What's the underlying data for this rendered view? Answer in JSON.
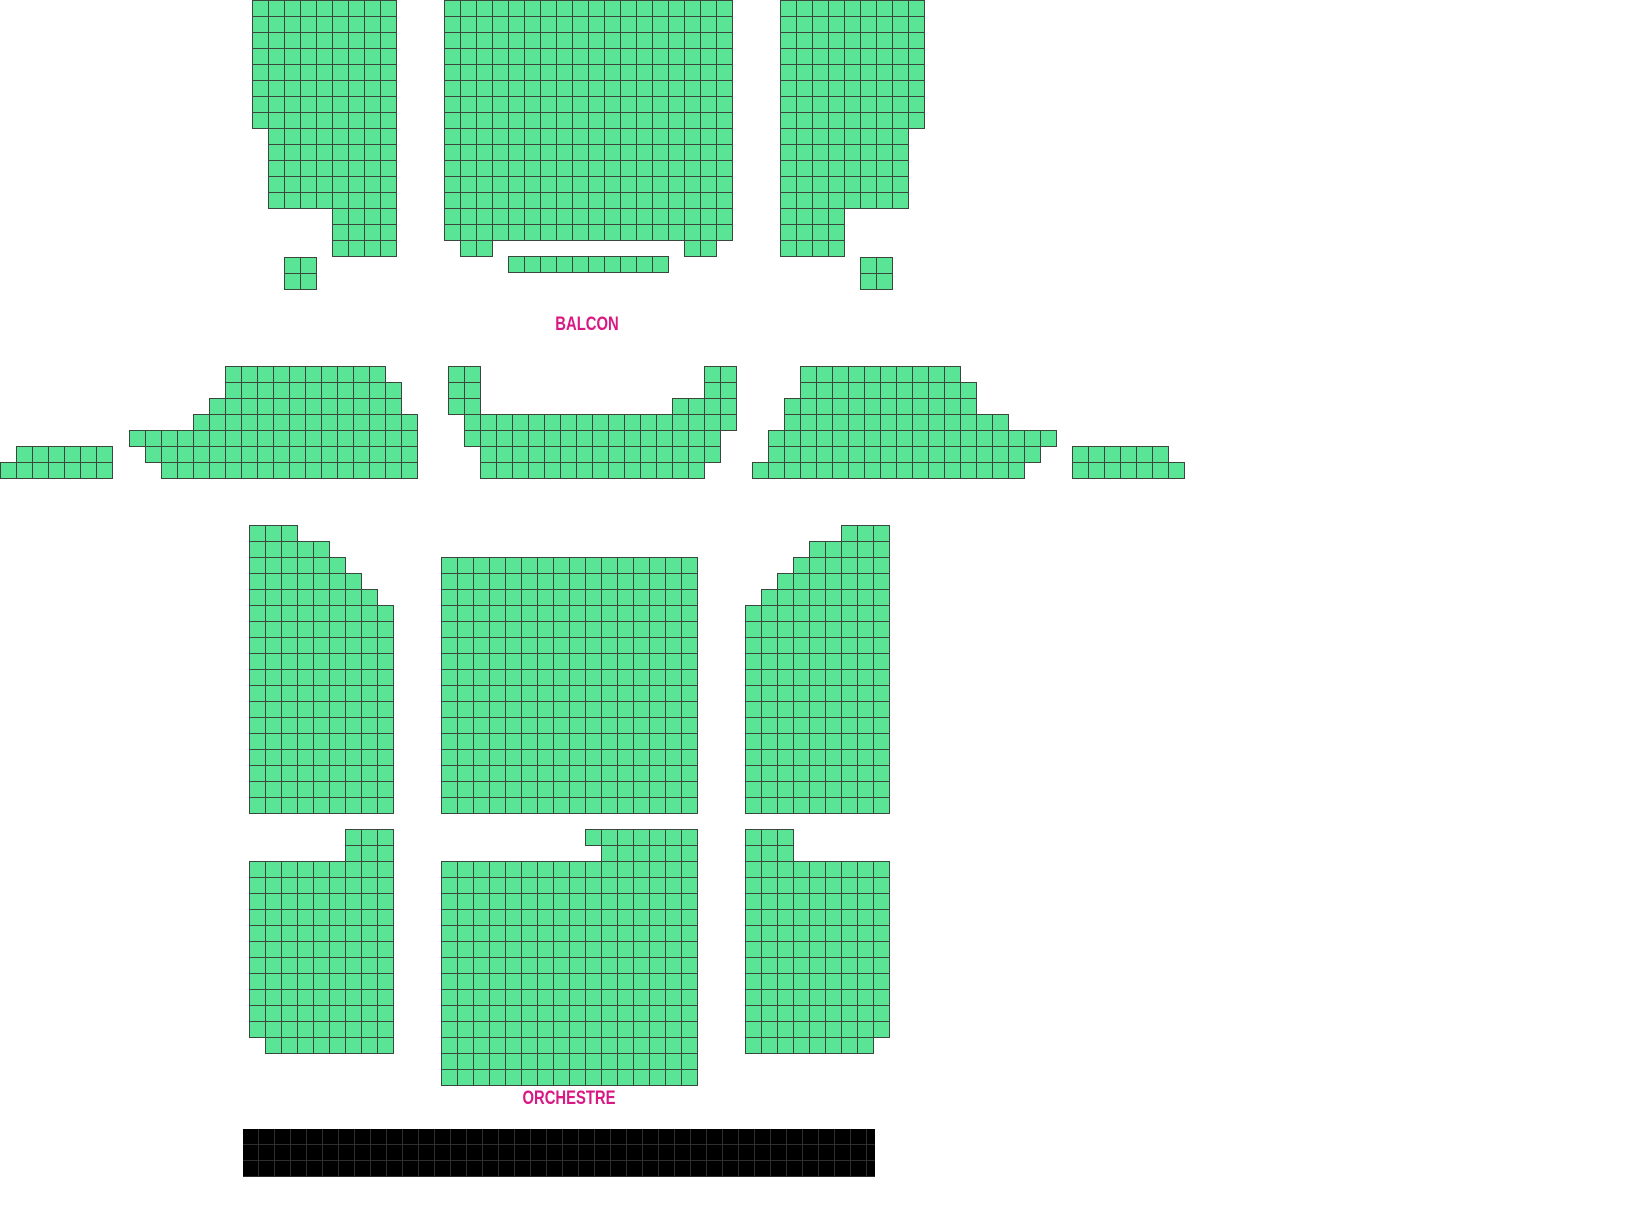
{
  "app": {
    "background": "#ffffff"
  },
  "seat": {
    "cell": 16,
    "fill": "#5AE496",
    "border": "#3A473C",
    "status_shown": "available"
  },
  "labels": {
    "color": "#D91884"
  },
  "sections": [
    {
      "id": "balcon",
      "label": "BALCON",
      "label_x": 587,
      "label_y": 316,
      "blocks": [
        {
          "name": "balcon-left-block",
          "rects": [
            [
              252,
              0,
              9,
              8
            ],
            [
              268,
              128,
              8,
              5
            ],
            [
              332,
              208,
              4,
              3
            ],
            [
              284,
              257,
              2,
              2
            ]
          ]
        },
        {
          "name": "balcon-center-block",
          "rects": [
            [
              444,
              0,
              18,
              15
            ],
            [
              460,
              240,
              2,
              1
            ],
            [
              684,
              240,
              2,
              1
            ],
            [
              508,
              256,
              10,
              1
            ]
          ]
        },
        {
          "name": "balcon-right-block",
          "rects": [
            [
              780,
              0,
              9,
              8
            ],
            [
              780,
              128,
              8,
              5
            ],
            [
              780,
              208,
              4,
              3
            ],
            [
              860,
              257,
              2,
              2
            ]
          ]
        }
      ]
    },
    {
      "id": "mezzanine",
      "label": "MEZZANINE",
      "label_x": 587,
      "label_y": 461,
      "blocks": [
        {
          "name": "mezzanine-far-left-block",
          "rects": [
            [
              16,
              446,
              6,
              1
            ],
            [
              0,
              462,
              7,
              1
            ]
          ]
        },
        {
          "name": "mezzanine-left-block",
          "rects": [
            [
              225,
              366,
              10,
              1
            ],
            [
              225,
              382,
              11,
              1
            ],
            [
              209,
              398,
              12,
              1
            ],
            [
              193,
              414,
              14,
              1
            ],
            [
              129,
              430,
              18,
              1
            ],
            [
              145,
              446,
              17,
              1
            ],
            [
              161,
              462,
              16,
              1
            ]
          ]
        },
        {
          "name": "mezzanine-center-block",
          "rects": [
            [
              448,
              366,
              2,
              3
            ],
            [
              704,
              366,
              2,
              3
            ],
            [
              672,
              398,
              2,
              1
            ],
            [
              464,
              414,
              17,
              1
            ],
            [
              464,
              430,
              16,
              1
            ],
            [
              480,
              446,
              15,
              1
            ],
            [
              480,
              462,
              14,
              1
            ]
          ]
        },
        {
          "name": "mezzanine-right-block",
          "rects": [
            [
              800,
              366,
              10,
              1
            ],
            [
              800,
              382,
              11,
              1
            ],
            [
              784,
              398,
              12,
              1
            ],
            [
              784,
              414,
              14,
              1
            ],
            [
              768,
              430,
              18,
              1
            ],
            [
              768,
              446,
              17,
              1
            ],
            [
              752,
              462,
              17,
              1
            ]
          ]
        },
        {
          "name": "mezzanine-far-right-block",
          "rects": [
            [
              1072,
              446,
              6,
              1
            ],
            [
              1072,
              462,
              7,
              1
            ]
          ]
        }
      ]
    },
    {
      "id": "orchestre",
      "label": "ORCHESTRE",
      "label_x": 569,
      "label_y": 1090,
      "blocks": [
        {
          "name": "orchestre-top-left-block",
          "rects": [
            [
              249,
              525,
              3,
              1
            ],
            [
              249,
              541,
              5,
              1
            ],
            [
              249,
              557,
              6,
              1
            ],
            [
              249,
              573,
              7,
              1
            ],
            [
              249,
              589,
              8,
              1
            ],
            [
              249,
              605,
              9,
              13
            ]
          ]
        },
        {
          "name": "orchestre-top-center-block",
          "rects": [
            [
              441,
              557,
              16,
              16
            ]
          ]
        },
        {
          "name": "orchestre-top-right-block",
          "rects": [
            [
              841,
              525,
              3,
              1
            ],
            [
              809,
              541,
              5,
              1
            ],
            [
              793,
              557,
              6,
              1
            ],
            [
              777,
              573,
              7,
              1
            ],
            [
              761,
              589,
              8,
              1
            ],
            [
              745,
              605,
              9,
              13
            ]
          ]
        },
        {
          "name": "orchestre-bottom-left-block",
          "rects": [
            [
              345,
              829,
              3,
              2
            ],
            [
              249,
              861,
              9,
              11
            ],
            [
              265,
              1037,
              8,
              1
            ]
          ]
        },
        {
          "name": "orchestre-bottom-center-block",
          "rects": [
            [
              585,
              829,
              7,
              1
            ],
            [
              601,
              845,
              6,
              1
            ],
            [
              441,
              861,
              16,
              14
            ]
          ]
        },
        {
          "name": "orchestre-bottom-right-block",
          "rects": [
            [
              745,
              829,
              3,
              2
            ],
            [
              745,
              861,
              9,
              11
            ],
            [
              745,
              1037,
              8,
              1
            ]
          ]
        }
      ]
    }
  ],
  "stage": {
    "x": 243,
    "y": 1129,
    "width": 632,
    "height": 48,
    "cell": 16,
    "fill": "#000000",
    "line": "#2E2E2E"
  }
}
